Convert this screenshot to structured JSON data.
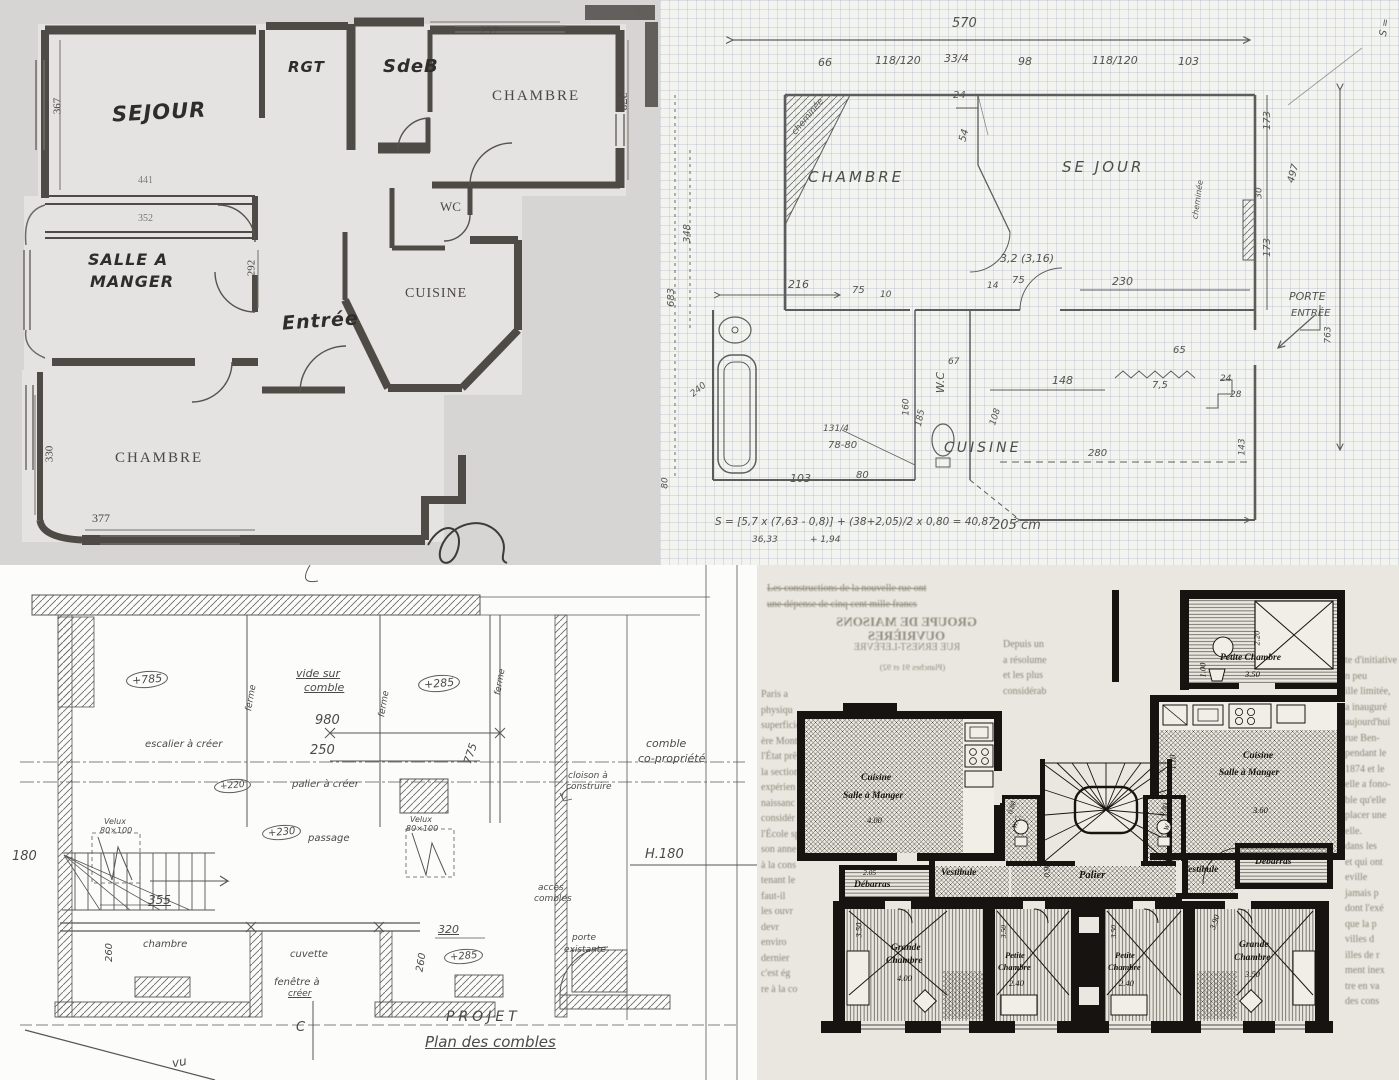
{
  "tl": {
    "rooms": {
      "sejour": "SEJOUR",
      "rgt": "RGT",
      "sdb": "SdeB",
      "chambre_top": "CHAMBRE",
      "wc": "WC",
      "sam1": "SALLE A",
      "sam2": "MANGER",
      "entree": "Entrée",
      "cuisine": "CUISINE",
      "chambre_bottom": "CHAMBRE"
    },
    "dims": {
      "d257": "257",
      "d278": "278",
      "d367": "367",
      "d441": "441",
      "d352": "352",
      "d292": "292",
      "d330": "330",
      "d377": "377"
    }
  },
  "tr": {
    "rooms": {
      "chambre": "CHAMBRE",
      "sejour": "SE JOUR",
      "cuisine": "CUISINE",
      "wc": "W.C"
    },
    "labels": {
      "cheminee_left": "cheminée",
      "cheminee_right": "cheminée",
      "porte": "PORTE",
      "entree": "ENTRÉE",
      "s_corner": "S ="
    },
    "dims": {
      "total": "570",
      "c1": "66",
      "c2": "118/120",
      "c3": "33/4",
      "c4": "98",
      "c5": "118/120",
      "c6": "103",
      "d24": "24",
      "d54": "54",
      "r173a": "173",
      "r30": "30",
      "r497": "497",
      "r173b": "173",
      "r763": "763",
      "v348": "348",
      "v683": "683",
      "v80": "80",
      "d216": "216",
      "d75a": "75",
      "d75b": "75",
      "d14": "14",
      "d10": "10",
      "mid": "3,2 (3,16)",
      "d230": "230",
      "d240": "240",
      "d160": "160",
      "d185": "185",
      "d67": "67",
      "d131": "131/4",
      "d7880": "78-80",
      "d103": "103",
      "d80": "80",
      "d108": "108",
      "d148": "148",
      "d75z": "7,5",
      "d65": "65",
      "d24b": "24",
      "d28": "28",
      "d143": "143",
      "d280": "280",
      "d205": "205 cm"
    },
    "formula": {
      "main": "S = [5,7 x (7,63 - 0,8)] + (38+2,05)/2 x 0,80 = 40,87",
      "sub1": "36,33",
      "sub2": "+ 1,94"
    }
  },
  "bl": {
    "labels": {
      "plus785": "+785",
      "vide1": "vide sur",
      "vide2": "comble",
      "plus285a": "+285",
      "ferme": "ferme",
      "d980": "980",
      "d250": "250",
      "escalier": "escalier à créer",
      "plus220": "+220",
      "palier": "palier à créer",
      "d775": "775",
      "comble1": "comble",
      "comble2": "co-propriété",
      "cloison1": "cloison à",
      "cloison2": "construire",
      "plus230": "+230",
      "passage": "passage",
      "velux": "Velux",
      "velux_size": "80×100",
      "d180": "180",
      "h180": "H.180",
      "d355": "355",
      "chambre": "chambre",
      "d260": "260",
      "d320": "320",
      "plus285b": "+285",
      "acces1": "accès",
      "acces2": "combles",
      "cuvette": "cuvette",
      "fen1": "fenêtre à",
      "fen2": "créer",
      "porte1": "porte",
      "porte2": "existante",
      "cmark": "C",
      "projet": "PROJET",
      "titre": "Plan des combles",
      "note": "vu"
    }
  },
  "br": {
    "headline": "GROUPE DE MAISONS OUVRIÈRES",
    "subhead": "RUE ERNEST-LEFÈVRE",
    "planches": "(Planches 91 et 92)",
    "rooms": {
      "petite_chambre": "Petite Chambre",
      "cuisine": "Cuisine",
      "sam": "Salle à Manger",
      "palier": "Palier",
      "vestibule": "Vestibule",
      "debarras": "Débarras",
      "wc": "W.C.",
      "grande": "Grande",
      "petite": "Petite",
      "chambre": "Chambre"
    },
    "dims": {
      "d350": "3.50",
      "d220": "2.20",
      "d100": "1.00",
      "d110": "1.10",
      "d360": "3.60",
      "d400": "4.00",
      "d240": "2.40",
      "d390": "3.90",
      "d080": "0.80",
      "d090": "0.90",
      "d205": "2.05"
    },
    "news": {
      "top": "Les constructions de la nouvelle rue ont\nune dépense de cinq cent mille francs",
      "left": "Paris a\nphysiqu\nsuperficie\nère Mont\nl'État prê\nla section\nexpérien\nnaissanc\nconsidér\nl'École sp\nson anne\nà la cons\ntenant le\nfaut-il\nles ouvr\ndevr\nenviro\ndernier\nc'est ég\nre à la co",
      "mid": "Depuis un\na résolume\net les plus\nconsidérab",
      "right": "te d'initiative\nn peu\nille limitée,\na inauguré\naujourd'hui\nrue Ben-\npendant le\n1874 et le\nelle a fono-\nble qu'elle\nplacer une\nelle.\ndans les\net qui ont\neville\njamais p\ndont l'exé\nque la p\nvilles d\nilles de r\nment inex\ntre en va\ndes cons"
    }
  }
}
